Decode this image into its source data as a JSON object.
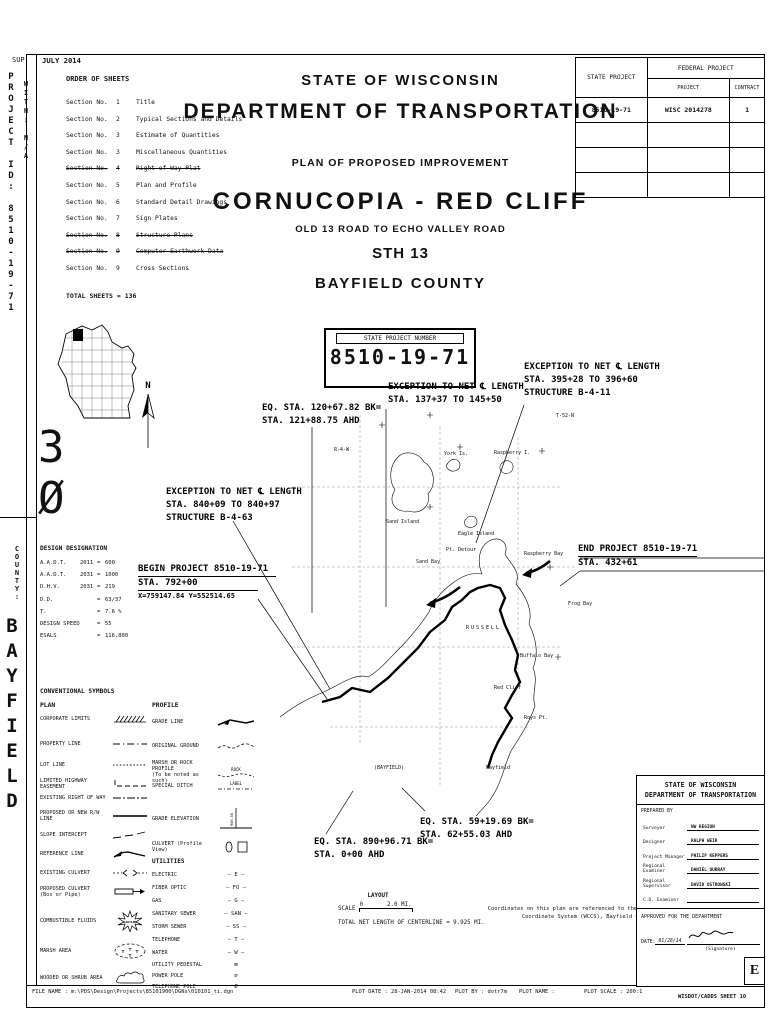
{
  "sheet": {
    "sup": "SUP",
    "issue_date": "JULY 2014",
    "margin": {
      "project_id": "PROJECT ID: 8510-19-71",
      "with_id": "WITH: N/A",
      "big_number": "3Ø",
      "county_label": "COUNTY:",
      "county": "BAYFIELD"
    }
  },
  "order": {
    "title": "ORDER OF SHEETS",
    "sec_label": "Section No.",
    "items": [
      {
        "no": "1",
        "name": "Title"
      },
      {
        "no": "2",
        "name": "Typical Sections and Details"
      },
      {
        "no": "3",
        "name": "Estimate of Quantities"
      },
      {
        "no": "3",
        "name": "Miscellaneous Quantities"
      },
      {
        "no": "4",
        "name": "Right of Way Plat"
      },
      {
        "no": "5",
        "name": "Plan and Profile"
      },
      {
        "no": "6",
        "name": "Standard Detail Drawings"
      },
      {
        "no": "7",
        "name": "Sign Plates"
      },
      {
        "no": "8",
        "name": "Structure Plans"
      },
      {
        "no": "9",
        "name": "Computer Earthwork Data"
      },
      {
        "no": "9",
        "name": "Cross Sections"
      }
    ],
    "total": "TOTAL SHEETS = 136"
  },
  "titles": {
    "state": "STATE OF WISCONSIN",
    "dept": "DEPARTMENT OF TRANSPORTATION",
    "plan": "PLAN OF PROPOSED IMPROVEMENT",
    "project": "CORNUCOPIA - RED CLIFF",
    "limits": "OLD 13 ROAD TO ECHO VALLEY ROAD",
    "highway": "STH 13",
    "county": "BAYFIELD COUNTY"
  },
  "fed_table": {
    "state_project": "STATE PROJECT",
    "federal_project": "FEDERAL PROJECT",
    "project": "PROJECT",
    "contract": "CONTRACT",
    "row": {
      "state": "8510-19-71",
      "project": "WISC 2014278",
      "contract": "1"
    }
  },
  "spn": {
    "label": "STATE PROJECT NUMBER",
    "number": "8510-19-71"
  },
  "north": "N",
  "notes": {
    "eq120": {
      "l1": "EQ. STA. 120+67.82 BK=",
      "l2": "STA. 121+88.75 AHD"
    },
    "exc137": {
      "l1": "EXCEPTION TO NET ℄ LENGTH",
      "l2": "STA. 137+37 TO 145+50"
    },
    "exc395": {
      "l1": "EXCEPTION TO NET ℄ LENGTH",
      "l2": "STA. 395+28 TO 396+60",
      "l3": "STRUCTURE B-4-11"
    },
    "exc840": {
      "l1": "EXCEPTION TO NET ℄ LENGTH",
      "l2": "STA. 840+09 TO 840+97",
      "l3": "STRUCTURE B-4-63"
    },
    "begin": {
      "l1": "BEGIN PROJECT 8510-19-71",
      "l2": "STA. 792+00",
      "l3": "X=759147.84 Y=552514.65"
    },
    "end": {
      "l1": "END PROJECT 8510-19-71",
      "l2": "STA. 432+61"
    },
    "eq59": {
      "l1": "EQ. STA. 59+19.69 BK=",
      "l2": "STA. 62+55.03 AHD"
    },
    "eq890": {
      "l1": "EQ. STA. 890+96.71 BK=",
      "l2": "STA. 0+00 AHD"
    }
  },
  "map_labels": {
    "sand_island": "Sand Island",
    "york": "York Is.",
    "raspberry_island": "Raspberry I.",
    "eagle": "Eagle Island",
    "pt_detour": "Pt. Detour",
    "sand_bay": "Sand Bay",
    "raspberry_bay": "Raspberry Bay",
    "frog_bay": "Frog Bay",
    "buffalo_bay": "Buffalo Bay",
    "red_cliff": "Red Cliff",
    "roys_pt": "Roys Pt.",
    "russell": "RUSSELL",
    "bayfield_town": "(BAYFIELD)",
    "bayfield": "Bayfield",
    "t52": "T-52-N",
    "r4w": "R-4-W"
  },
  "design": {
    "title": "DESIGN DESIGNATION",
    "rows": [
      {
        "label": "A.A.D.T.",
        "year": "2011",
        "eq": "=",
        "value": "600"
      },
      {
        "label": "A.A.D.T.",
        "year": "2031",
        "eq": "=",
        "value": "1000"
      },
      {
        "label": "D.H.V.",
        "year": "2031",
        "eq": "=",
        "value": "219"
      },
      {
        "label": "D.D.",
        "year": "",
        "eq": "=",
        "value": "63/37"
      },
      {
        "label": "T.",
        "year": "",
        "eq": "=",
        "value": "7.6 %"
      },
      {
        "label": "DESIGN SPEED",
        "year": "",
        "eq": "=",
        "value": "55"
      },
      {
        "label": "ESALS",
        "year": "",
        "eq": "=",
        "value": "116,800"
      }
    ]
  },
  "symbols": {
    "title": "CONVENTIONAL SYMBOLS",
    "plan_heading": "PLAN",
    "profile_heading": "PROFILE",
    "plan": [
      {
        "label": "CORPORATE LIMITS"
      },
      {
        "label": "PROPERTY LINE"
      },
      {
        "label": "LOT LINE"
      },
      {
        "label": "LIMITED HIGHWAY EASEMENT"
      },
      {
        "label": "EXISTING RIGHT OF WAY"
      },
      {
        "label": "PROPOSED OR NEW R/W LINE"
      },
      {
        "label": "SLOPE INTERCEPT"
      },
      {
        "label": "REFERENCE LINE"
      },
      {
        "label": "EXISTING CULVERT"
      },
      {
        "label": "PROPOSED CULVERT",
        "sub": "(Box or Pipe)"
      },
      {
        "label": "COMBUSTIBLE FLUIDS"
      },
      {
        "label": "MARSH AREA"
      },
      {
        "label": "WOODED OR SHRUB AREA"
      }
    ],
    "profile": [
      {
        "label": "GRADE LINE"
      },
      {
        "label": "ORIGINAL GROUND"
      },
      {
        "label": "MARSH OR ROCK PROFILE",
        "sub": "(To be noted as such)"
      },
      {
        "label": "SPECIAL DITCH"
      },
      {
        "label": "GRADE ELEVATION"
      },
      {
        "label": "CULVERT (Profile View)"
      }
    ],
    "utilities_heading": "UTILITIES",
    "utilities": [
      {
        "label": "ELECTRIC",
        "glyph": "— E —"
      },
      {
        "label": "FIBER OPTIC",
        "glyph": "— FO —"
      },
      {
        "label": "GAS",
        "glyph": "— G —"
      },
      {
        "label": "SANITARY SEWER",
        "glyph": "— SAN —"
      },
      {
        "label": "STORM SEWER",
        "glyph": "— SS —"
      },
      {
        "label": "TELEPHONE",
        "glyph": "— T —"
      },
      {
        "label": "WATER",
        "glyph": "— W —"
      },
      {
        "label": "UTILITY PEDESTAL",
        "glyph": "⊠"
      },
      {
        "label": "POWER POLE",
        "glyph": "⌀"
      },
      {
        "label": "TELEPHONE POLE",
        "glyph": "Ø"
      }
    ],
    "rock_text": "ROCK",
    "label_text": "LABEL",
    "caution": "CAUTION"
  },
  "layout_block": {
    "title": "LAYOUT",
    "scale_label": "SCALE",
    "zero": "0",
    "max": "2.0 MI.",
    "total": "TOTAL NET LENGTH OF CENTERLINE = 9.925 MI."
  },
  "coord_note": {
    "l1": "Coordinates on this plan are referenced to the Wisconsin County",
    "l2": "Coordinate System (WCCS), Bayfield County."
  },
  "approval": {
    "line1": "STATE OF WISCONSIN",
    "line2": "DEPARTMENT OF TRANSPORTATION",
    "prepared": "PREPARED BY",
    "rows": [
      {
        "label": "Surveyor",
        "value": "NW REGION"
      },
      {
        "label": "Designer",
        "value": "RALPH WEIR"
      },
      {
        "label": "Project Manager",
        "value": "PHILIP KEPPERS"
      },
      {
        "label": "Regional Examiner",
        "value": "DANIEL OUBRAY"
      },
      {
        "label": "Regional Supervisor",
        "value": "DAVID OSTROWSKI"
      },
      {
        "label": "C.O. Examiner",
        "value": ""
      }
    ],
    "approved": "APPROVED FOR THE DEPARTMENT",
    "date_label": "DATE:",
    "date": "01/28/14",
    "signature": "(Signature)",
    "sheet_letter": "E"
  },
  "footer": {
    "file_name": "FILE NAME : m:\\PDS\\Design\\Projects\\85101900\\DGNs\\010101_ti.dgn",
    "plot_date": "PLOT DATE : 28-JAN-2014 08:42",
    "plot_by": "PLOT BY : dotr7m",
    "plot_name": "PLOT NAME :",
    "plot_scale": "PLOT SCALE : 200:1",
    "sheet_ref": "WISDOT/CADDS SHEET 10"
  }
}
